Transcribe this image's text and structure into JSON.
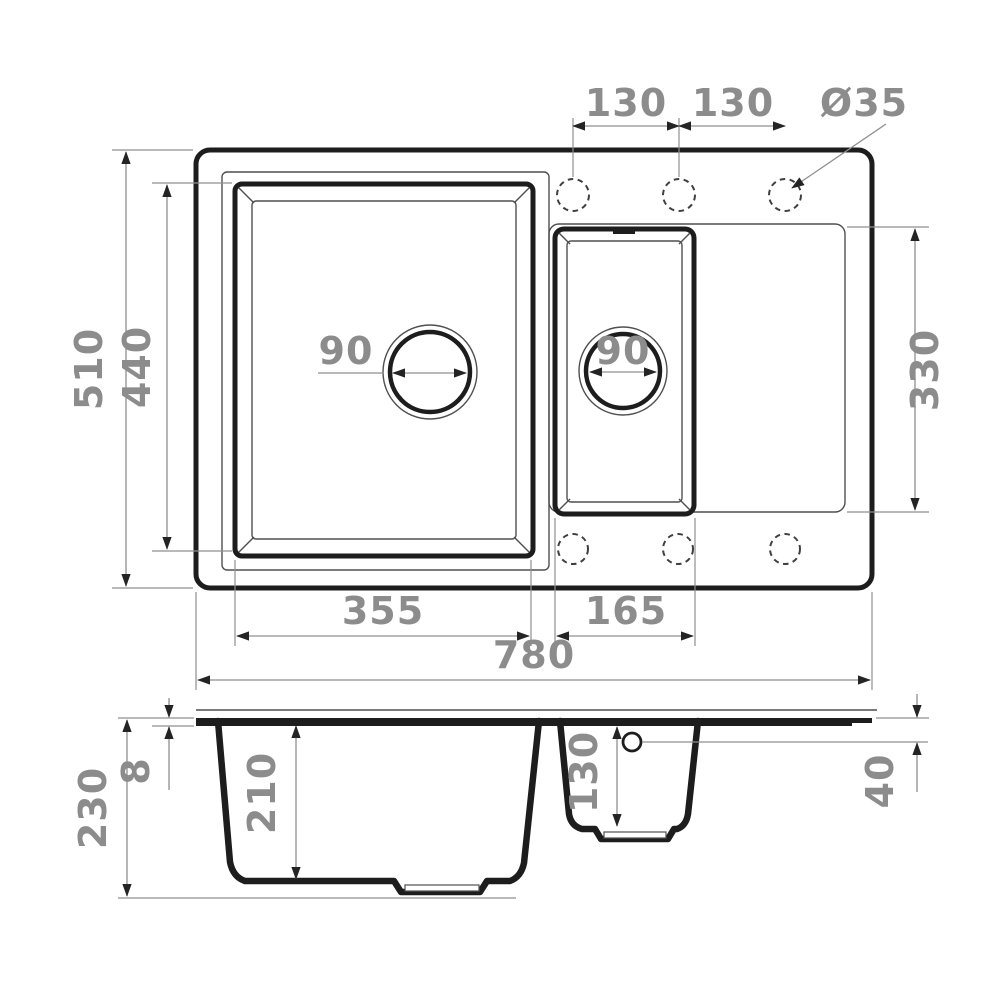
{
  "labels": {
    "hole_spacing_left": "130",
    "hole_spacing_right": "130",
    "hole_diameter": "Ø35",
    "overall_depth": "510",
    "main_bowl_depth": "440",
    "main_drain": "90",
    "small_drain": "90",
    "drainer_depth": "330",
    "main_bowl_width": "355",
    "small_bowl_width": "165",
    "overall_width": "780",
    "overall_height": "230",
    "rim_thickness": "8",
    "main_bowl_height": "210",
    "small_bowl_height": "130",
    "drainer_edge_height": "40"
  },
  "dimensions_mm": {
    "overall_width": 780,
    "overall_depth": 510,
    "overall_height": 230,
    "main_bowl_width": 355,
    "main_bowl_depth": 440,
    "main_bowl_height": 210,
    "small_bowl_width": 165,
    "small_bowl_height": 130,
    "drainer_depth": 330,
    "drainer_edge_height": 40,
    "rim_thickness": 8,
    "drain_diameter_main": 90,
    "drain_diameter_small": 90,
    "faucet_hole_spacing": [
      130,
      130
    ],
    "faucet_hole_diameter": 35
  }
}
